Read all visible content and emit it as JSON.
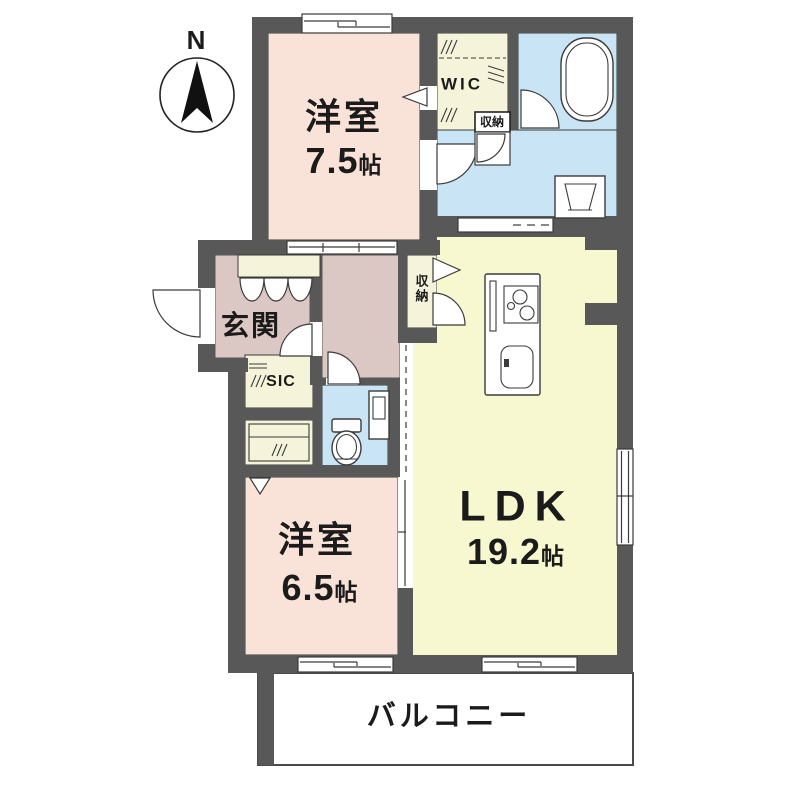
{
  "compass": {
    "north_label": "N"
  },
  "rooms": {
    "bedroom1": {
      "name": "洋室",
      "size_value": "7.5",
      "size_unit": "帖"
    },
    "bedroom2": {
      "name": "洋室",
      "size_value": "6.5",
      "size_unit": "帖"
    },
    "ldk": {
      "name": "LDK",
      "size_value": "19.2",
      "size_unit": "帖"
    },
    "wic": {
      "label": "WIC"
    },
    "wic_storage": {
      "label": "収納"
    },
    "hall_storage": {
      "label": "収納"
    },
    "genkan": {
      "label": "玄関"
    },
    "sic": {
      "label": "SIC"
    },
    "balcony": {
      "label": "バルコニー"
    }
  },
  "colors": {
    "wall": "#585858",
    "bedroom": "#F9E2D7",
    "entry": "#DBC7C3",
    "storage": "#F6F3DB",
    "water": "#C9E4F5",
    "ldk": "#F7F7D0",
    "line": "#3b3b3b",
    "text": "#1b1b1b"
  }
}
